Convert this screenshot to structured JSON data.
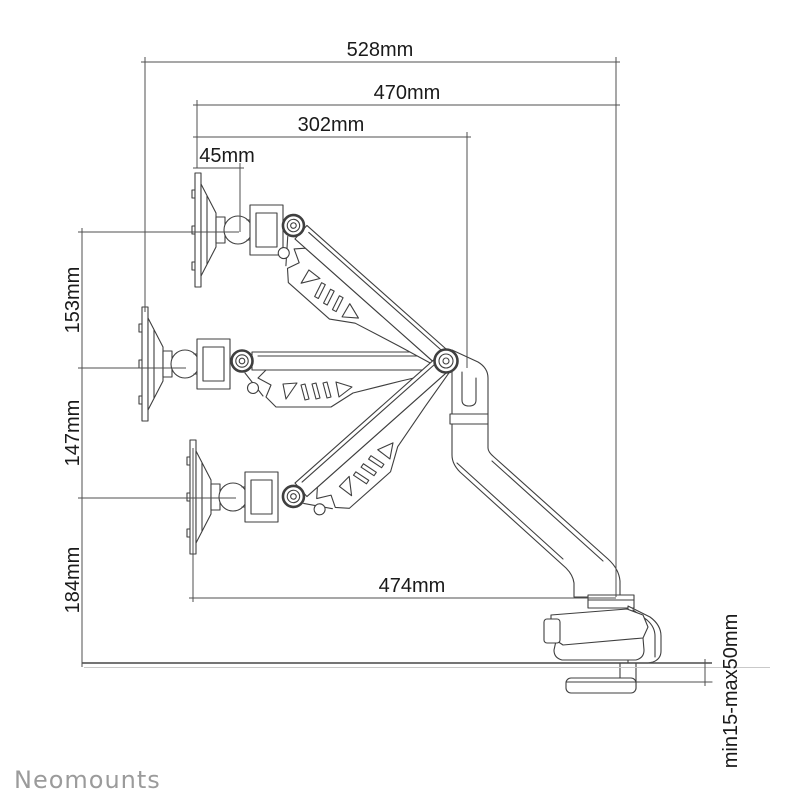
{
  "page": {
    "background": "#ffffff"
  },
  "brand": {
    "logo_text": "Neomounts",
    "color": "#9b9b9b"
  },
  "drawing": {
    "description": "Side-view technical line drawing of a gas-spring desk-mounted monitor arm shown in three height positions (high, middle, low) with desk clamp",
    "line_color": "#3f3f3f",
    "dimension_line_color": "#4f4f4f",
    "text_color": "#1a1a1a"
  },
  "dimensions": {
    "d528": {
      "label": "528mm",
      "orientation": "horizontal"
    },
    "d470": {
      "label": "470mm",
      "orientation": "horizontal"
    },
    "d302": {
      "label": "302mm",
      "orientation": "horizontal"
    },
    "d45": {
      "label": "45mm",
      "orientation": "horizontal"
    },
    "d153": {
      "label": "153mm",
      "orientation": "vertical"
    },
    "d147": {
      "label": "147mm",
      "orientation": "vertical"
    },
    "d184": {
      "label": "184mm",
      "orientation": "vertical"
    },
    "d474": {
      "label": "474mm",
      "orientation": "horizontal"
    },
    "dclamp": {
      "label": "min15-max50mm",
      "orientation": "vertical"
    }
  }
}
